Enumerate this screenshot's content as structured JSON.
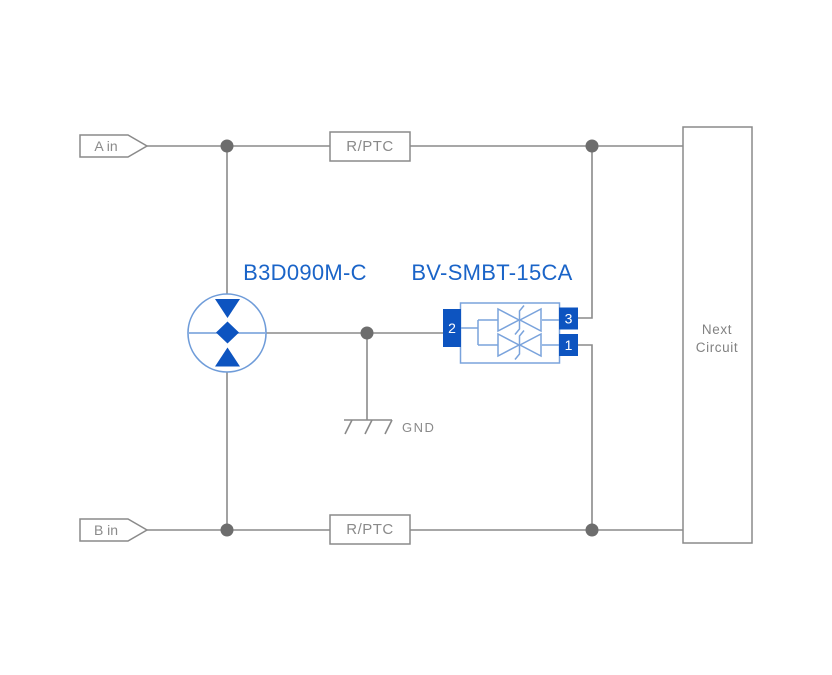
{
  "diagram": {
    "title_labels": {
      "gdt_part_number": "B3D090M-C",
      "tvs_part_number": "BV-SMBT-15CA"
    },
    "inputs": {
      "a_label": "A in",
      "b_label": "B in"
    },
    "resistors": {
      "top_label": "R/PTC",
      "bottom_label": "R/PTC"
    },
    "tvs_pins": {
      "left": "2",
      "top_right": "3",
      "bottom_right": "1"
    },
    "ground": {
      "label": "GND"
    },
    "next_circuit": {
      "line1": "Next",
      "line2": "Circuit"
    },
    "colors": {
      "wire_gray": "#8a8a8a",
      "junction_dot": "#6d6d6d",
      "component_blue_solid": "#0d54c0",
      "component_blue_outline": "#7aa3dc",
      "gdt_circle_outline": "#6f9cd9",
      "label_blue_text": "#1a64c8",
      "label_gray_text": "#8a8a8a",
      "background": "#ffffff"
    }
  }
}
